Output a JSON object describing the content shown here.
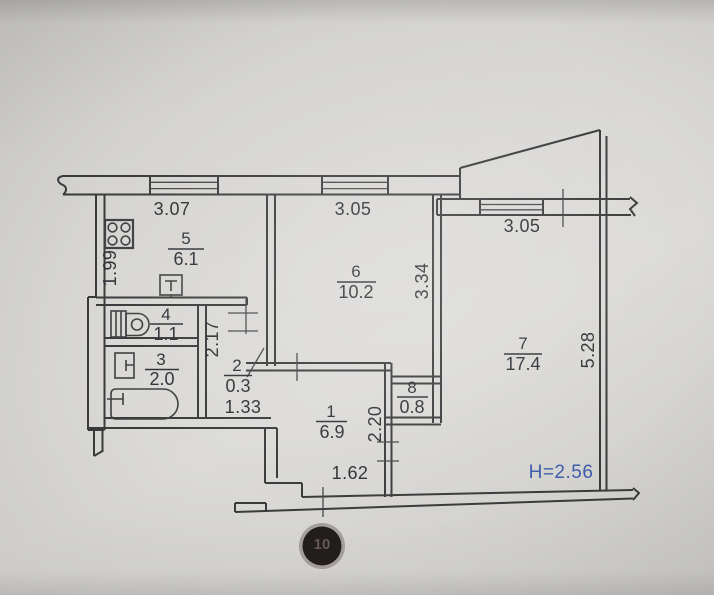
{
  "floorplan": {
    "rooms": [
      {
        "number": "1",
        "area": "6.9"
      },
      {
        "number": "2",
        "area": "0.3"
      },
      {
        "number": "3",
        "area": "2.0"
      },
      {
        "number": "4",
        "area": "1.1"
      },
      {
        "number": "5",
        "area": "6.1"
      },
      {
        "number": "6",
        "area": "10.2"
      },
      {
        "number": "7",
        "area": "17.4"
      },
      {
        "number": "8",
        "area": "0.8"
      }
    ],
    "dimensions": {
      "kitchen_width": "3.07",
      "room6_width": "3.05",
      "room7_width": "3.05",
      "kitchen_depth": "1.99",
      "corridor_depth": "2.17",
      "room6_depth": "3.34",
      "room7_depth": "5.28",
      "hall_depth": "2.20",
      "closet_width": "1.33",
      "entry_width": "1.62"
    },
    "ceiling_height": "H=2.56",
    "stamp": "10",
    "colors": {
      "ink": "#3a3a3c",
      "text": "#2d2f33",
      "accent_blue": "#3e5ca9",
      "paper": "#d6d5d2"
    }
  }
}
